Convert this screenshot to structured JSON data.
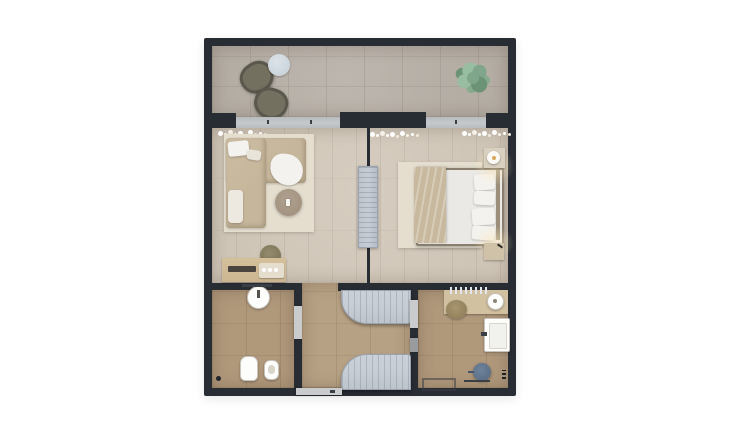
{
  "scene": {
    "type": "architectural-floor-plan-3d-render",
    "view": "top-down",
    "background": "white",
    "rooms": [
      {
        "name": "terrace",
        "floor": "stone-tile",
        "furniture": [
          "lounge-chair",
          "lounge-chair",
          "round-side-table",
          "potted-plant"
        ]
      },
      {
        "name": "living-room",
        "floor": "wood-plank",
        "furniture": [
          "corner-sofa",
          "throw-pillows",
          "round-coffee-table",
          "pouf-stool",
          "desk-console",
          "serving-tray",
          "sheer-curtains",
          "area-rug"
        ]
      },
      {
        "name": "bedroom",
        "floor": "wood-plank",
        "furniture": [
          "double-bed",
          "pillows",
          "throw-blanket",
          "nightstand-with-lamp",
          "nightstand",
          "area-rug",
          "sheer-curtains",
          "media-partition-panel"
        ]
      },
      {
        "name": "wc",
        "floor": "tan-tile",
        "furniture": [
          "round-washbasin",
          "toilet",
          "bidet"
        ]
      },
      {
        "name": "entry-hall",
        "floor": "tan-tile",
        "furniture": [
          "curved-wardrobe-unit",
          "curved-wardrobe-unit",
          "entrance-door"
        ]
      },
      {
        "name": "bathroom",
        "floor": "tan-tile",
        "furniture": [
          "vanity-counter",
          "round-washbasin",
          "wall-basin",
          "towel-ladder",
          "shower-stool",
          "bath-mat",
          "towel-rail",
          "basket"
        ]
      }
    ]
  },
  "colors": {
    "wall": "#282c33",
    "stone": "#b4ada4",
    "wood": "#cfc5b7",
    "tan": "#b0987b",
    "tanlight": "#b7a184",
    "rug": "#e5decf",
    "sofa": "#c6b69b",
    "white": "#f4f2ee",
    "blanket": "#c8b89d",
    "furnwood": "#cbb691",
    "glass": "#c6c9cc",
    "slat": "#c7cdd5",
    "slatline": "#99a2ae",
    "plant1": "#7fa58a",
    "plant2": "#6d9377",
    "plant3": "#98bda0",
    "olive": "#74705f",
    "olivedark": "#5a574c",
    "tableblue": "#ccd5dc",
    "stoolblue": "#5b6e87",
    "doorleaf": "#c9cbcd",
    "lampamber": "#d9a95a"
  }
}
